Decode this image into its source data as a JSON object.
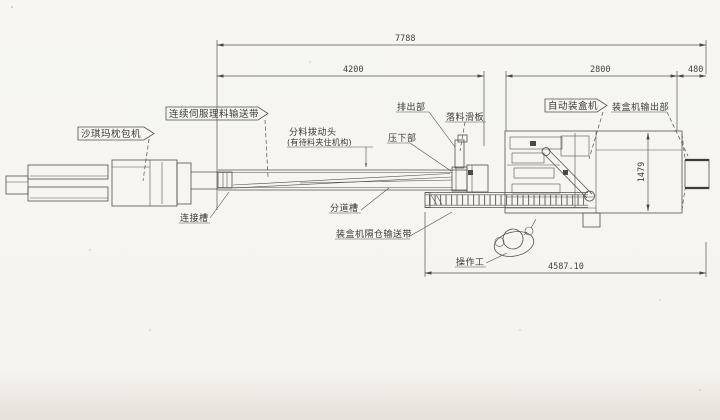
{
  "page": {
    "background": "#f5f4ee",
    "ink": "#54504a"
  },
  "labels": {
    "pillow_packer": "沙琪玛枕包机",
    "servo_conveyor": "连续伺服理料输送带",
    "divider_head": "分料拨动头",
    "divider_head_note": "(有待料夹住机构)",
    "discharge": "排出部",
    "drop_chute": "落料滑板",
    "press_down": "压下部",
    "auto_cartoner": "自动装盒机",
    "cartoner_output": "装盒机输出部",
    "connect_trough": "连接槽",
    "divide_channel": "分道槽",
    "cartoner_buffer_conveyor": "装盒机隔仓输送带",
    "operator": "操作工"
  },
  "dimensions": {
    "overall_length": "7788",
    "servo_conveyor_length": "4200",
    "cartoner_length": "2800",
    "output_length": "480",
    "cartoner_depth": "1479",
    "working_zone_length": "4587.10"
  }
}
